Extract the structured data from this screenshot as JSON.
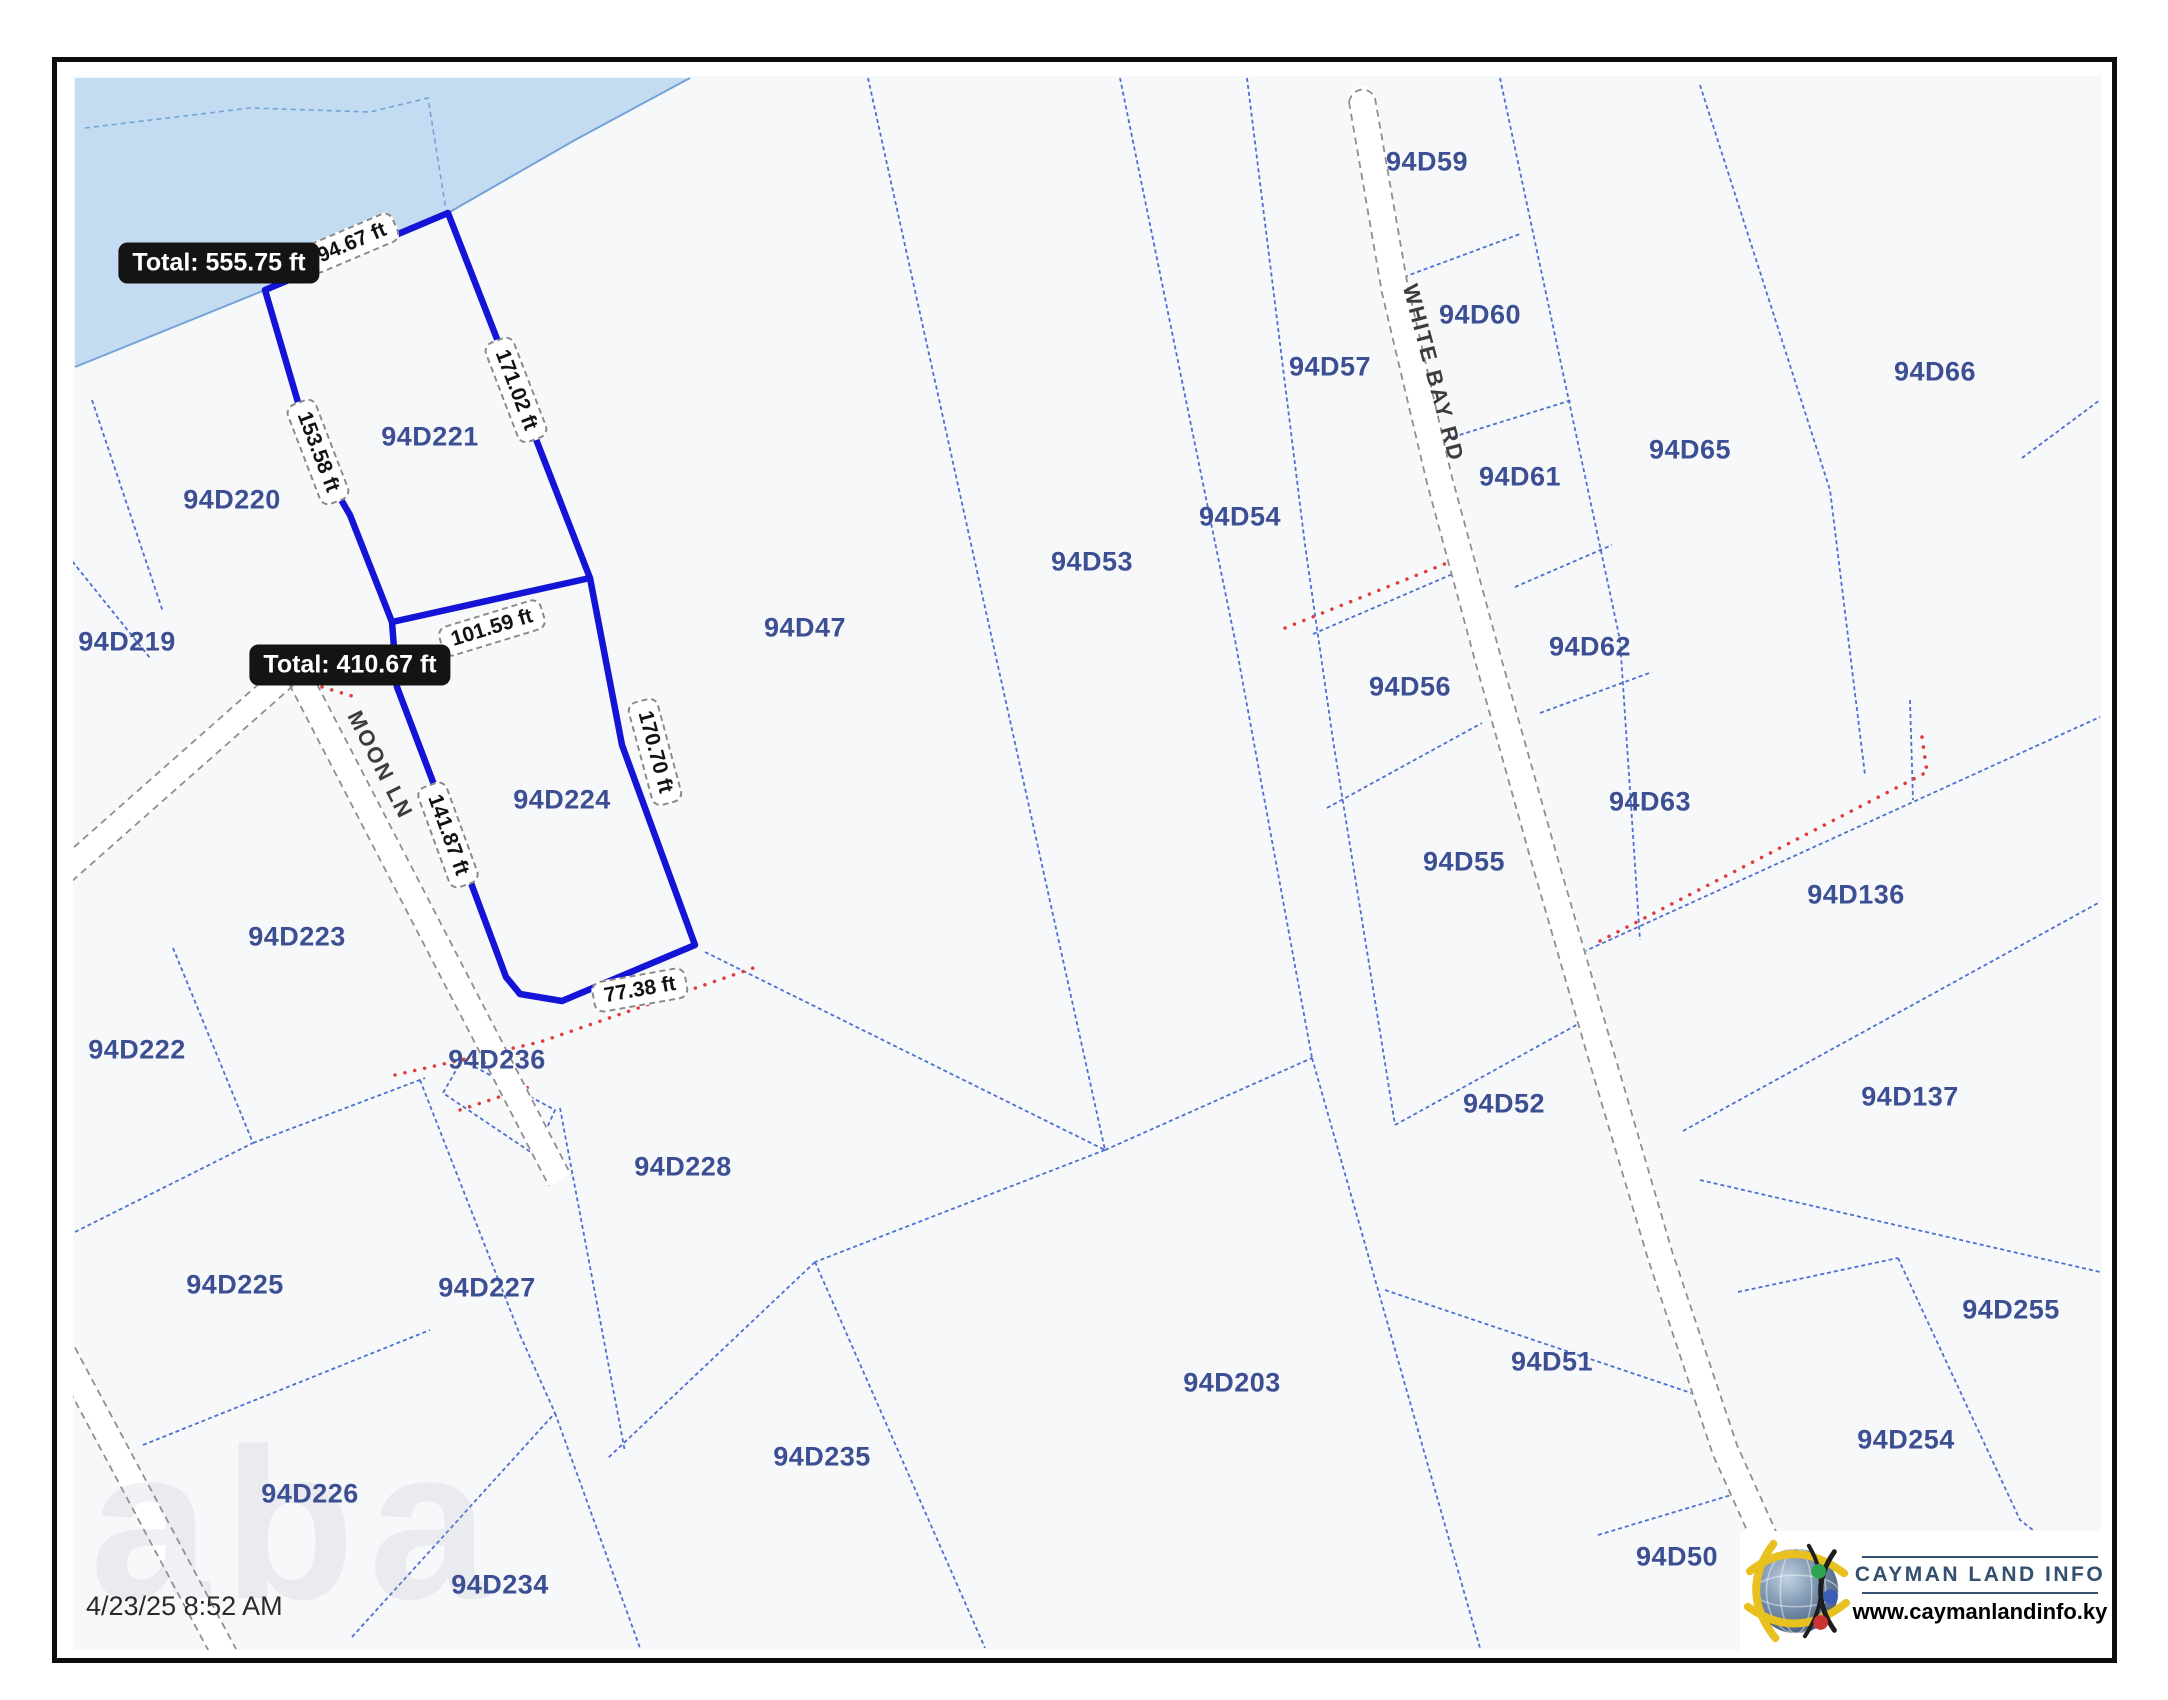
{
  "app": {
    "timestamp": "4/23/25 8:52 AM",
    "watermark": "aba"
  },
  "logo": {
    "brand": "CAYMAN LAND INFO",
    "website": "www.caymanlandinfo.ky"
  },
  "roads": [
    {
      "name": "MOON LN"
    },
    {
      "name": "WHITE BAY RD"
    }
  ],
  "selection": {
    "totals": [
      {
        "label": "Total: 555.75 ft"
      },
      {
        "label": "Total: 410.67 ft"
      }
    ],
    "segments": [
      {
        "label": "94.67 ft"
      },
      {
        "label": "171.02 ft"
      },
      {
        "label": "153.58 ft"
      },
      {
        "label": "101.59 ft"
      },
      {
        "label": "170.70 ft"
      },
      {
        "label": "141.87 ft"
      },
      {
        "label": "77.38 ft"
      }
    ]
  },
  "parcels": [
    {
      "label": "94D220"
    },
    {
      "label": "94D221"
    },
    {
      "label": "94D219"
    },
    {
      "label": "94D224"
    },
    {
      "label": "94D223"
    },
    {
      "label": "94D222"
    },
    {
      "label": "94D225"
    },
    {
      "label": "94D227"
    },
    {
      "label": "94D226"
    },
    {
      "label": "94D234"
    },
    {
      "label": "94D236"
    },
    {
      "label": "94D228"
    },
    {
      "label": "94D235"
    },
    {
      "label": "94D203"
    },
    {
      "label": "94D47"
    },
    {
      "label": "94D53"
    },
    {
      "label": "94D54"
    },
    {
      "label": "94D57"
    },
    {
      "label": "94D59"
    },
    {
      "label": "94D60"
    },
    {
      "label": "94D61"
    },
    {
      "label": "94D56"
    },
    {
      "label": "94D62"
    },
    {
      "label": "94D55"
    },
    {
      "label": "94D63"
    },
    {
      "label": "94D65"
    },
    {
      "label": "94D66"
    },
    {
      "label": "94D136"
    },
    {
      "label": "94D137"
    },
    {
      "label": "94D52"
    },
    {
      "label": "94D51"
    },
    {
      "label": "94D50"
    },
    {
      "label": "94D255"
    },
    {
      "label": "94D254"
    }
  ],
  "colors": {
    "selection_blue": "#1414d6",
    "parcel_line": "#4d6fd1",
    "parcel_label": "#3d4f93",
    "water": "#c3dcf2",
    "measure_red": "#e23b3b",
    "road_edge": "#8f8f8f"
  }
}
